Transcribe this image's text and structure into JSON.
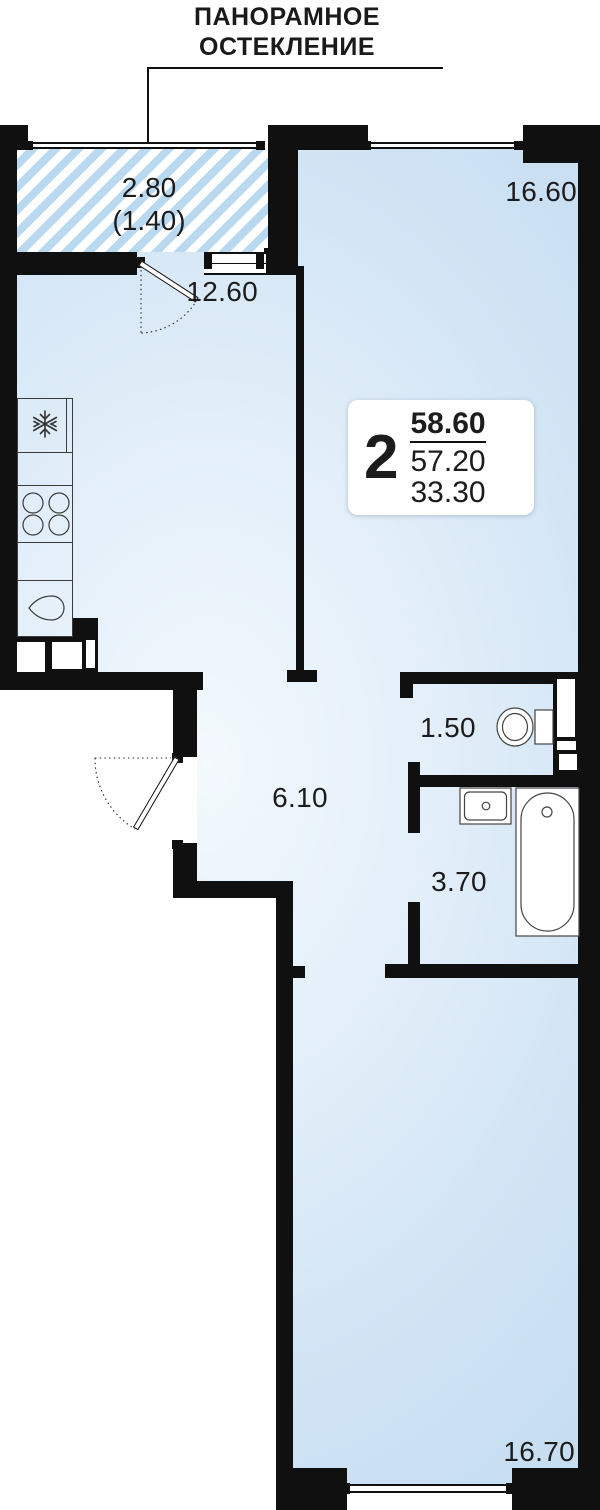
{
  "annotation": {
    "line1": "ПАНОРАМНОЕ",
    "line2": "ОСТЕКЛЕНИЕ"
  },
  "rooms": {
    "balcony": {
      "area": "2.80",
      "area_reduced": "(1.40)"
    },
    "kitchen_living": {
      "area": "12.60"
    },
    "bedroom": {
      "area": "16.60"
    },
    "wc": {
      "area": "1.50"
    },
    "hallway": {
      "area": "6.10"
    },
    "bathroom": {
      "area": "3.70"
    },
    "living_room": {
      "area": "16.70"
    }
  },
  "info_card": {
    "rooms_count": "2",
    "total_area": "58.60",
    "area_without_balcony": "57.20",
    "living_area": "33.30"
  },
  "icons": {
    "fridge": "snowflake-icon",
    "stove": "stove-burners-icon",
    "kitchen_sink": "kitchen-sink-icon",
    "toilet": "toilet-icon",
    "washbasin": "washbasin-icon",
    "bathtub": "bathtub-icon"
  },
  "colors": {
    "wall": "#101010",
    "floor_highlight": "#f3f9fd",
    "floor_blue": "#c5dcf0",
    "hatch_stripe": "#b9d9f1",
    "text": "#1c1c1c"
  }
}
